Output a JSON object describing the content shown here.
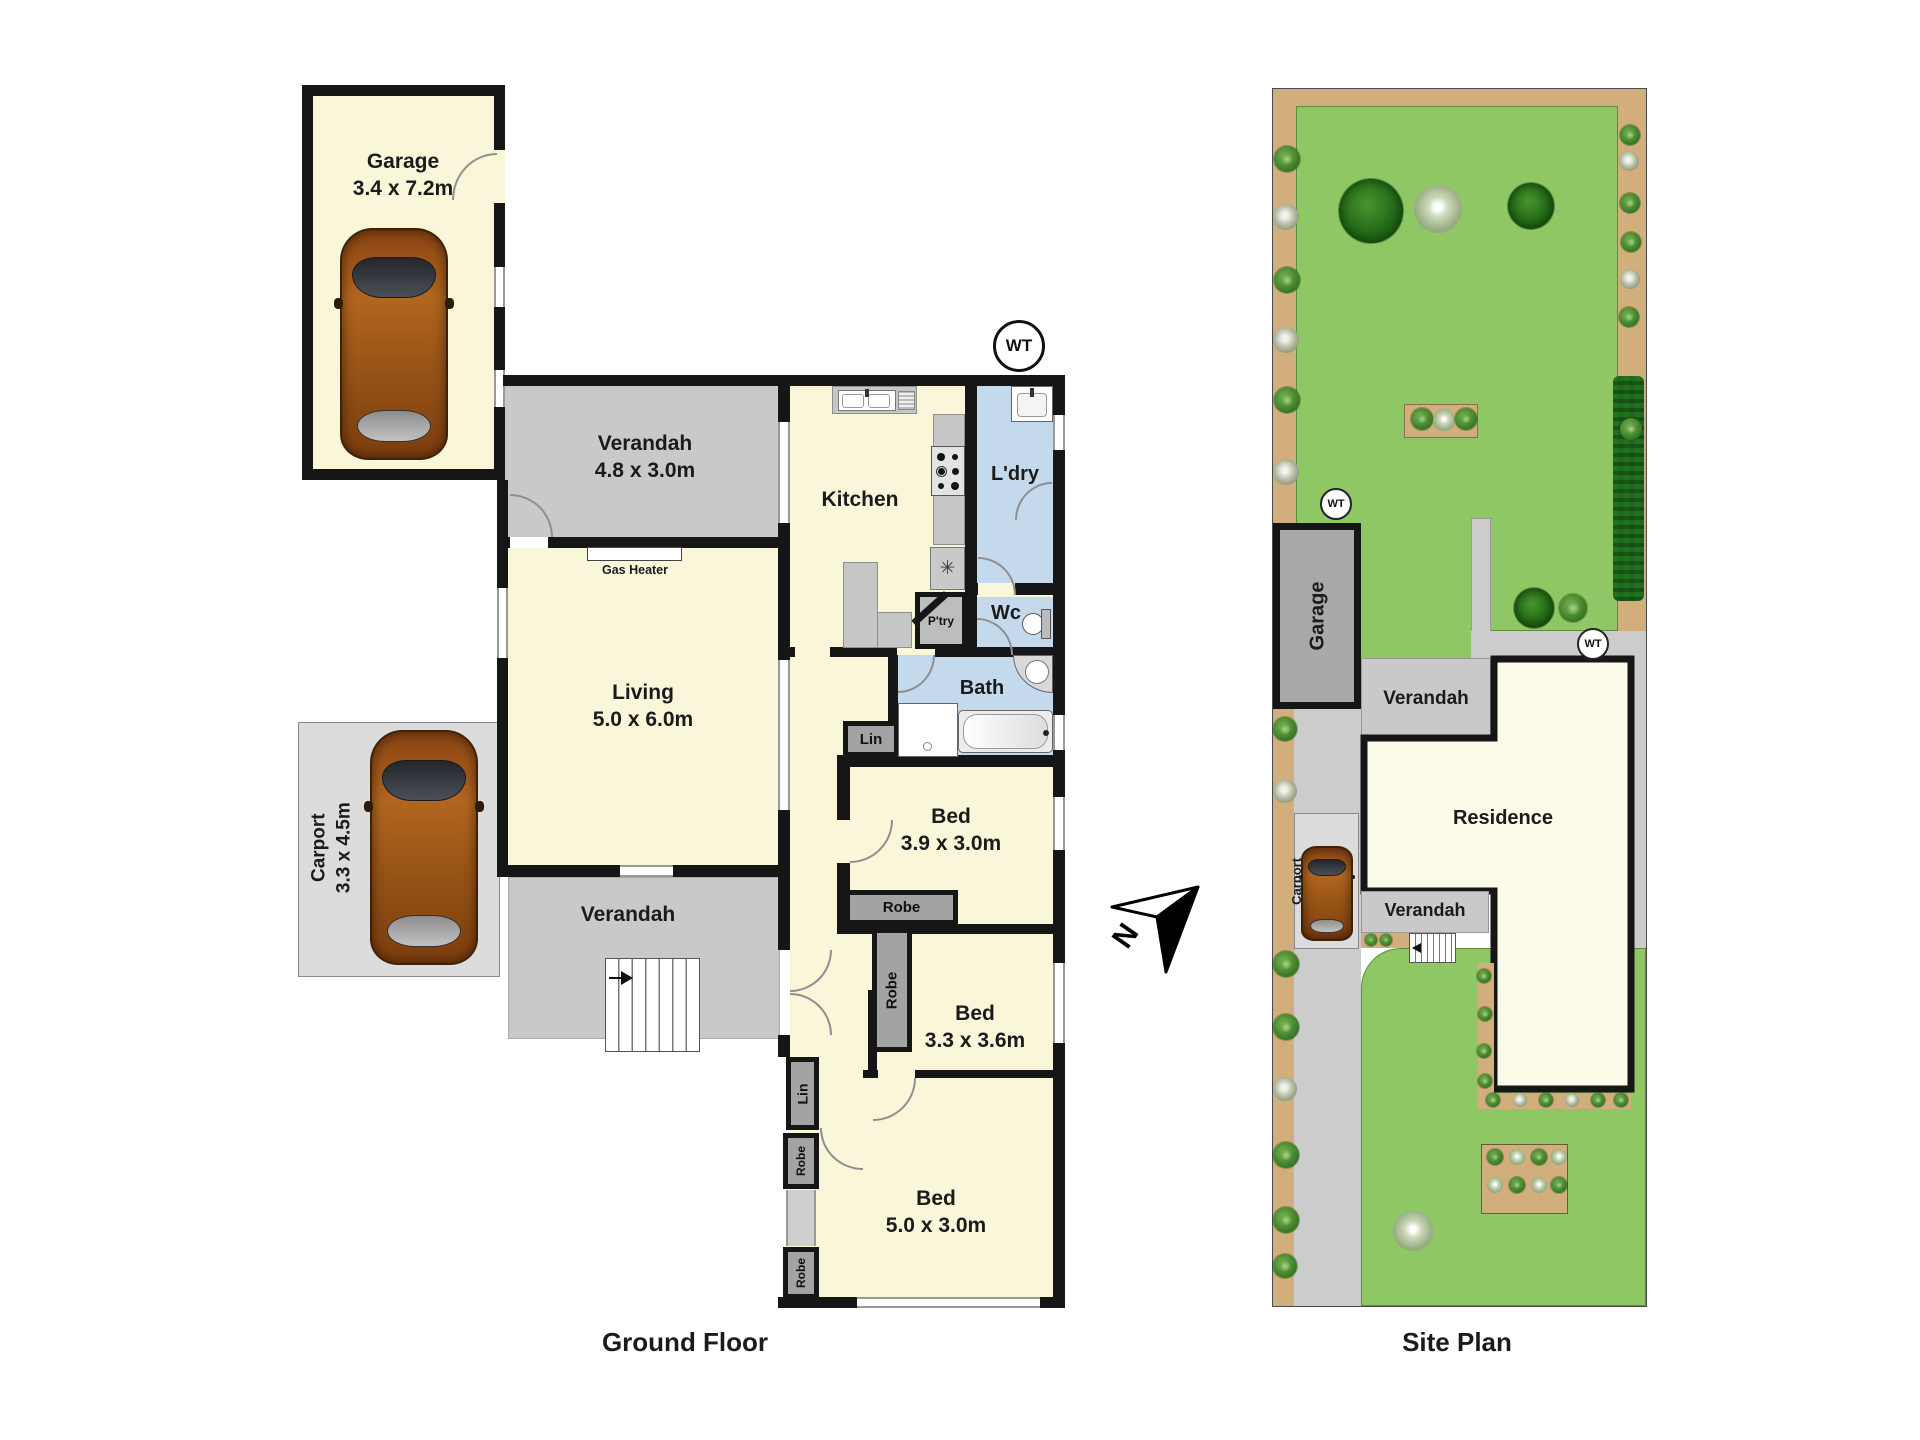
{
  "ground_floor": {
    "title": "Ground Floor",
    "garage": {
      "name": "Garage",
      "dims": "3.4 x 7.2m"
    },
    "verandah_top": {
      "name": "Verandah",
      "dims": "4.8 x 3.0m"
    },
    "kitchen": {
      "name": "Kitchen"
    },
    "laundry": {
      "name": "L'dry"
    },
    "pantry": {
      "name": "P'try"
    },
    "wc": {
      "name": "Wc"
    },
    "bath": {
      "name": "Bath"
    },
    "living": {
      "name": "Living",
      "dims": "5.0 x 6.0m"
    },
    "gas_heater": "Gas Heater",
    "carport": {
      "name": "Carport",
      "dims": "3.3 x 4.5m"
    },
    "verandah_mid": {
      "name": "Verandah"
    },
    "bed1": {
      "name": "Bed",
      "dims": "3.9 x 3.0m"
    },
    "bed2": {
      "name": "Bed",
      "dims": "3.3 x 3.6m"
    },
    "bed3": {
      "name": "Bed",
      "dims": "5.0 x 3.0m"
    },
    "lin1": "Lin",
    "lin2": "Lin",
    "robe1": "Robe",
    "robe2": "Robe",
    "robe3": "Robe",
    "robe4": "Robe",
    "water_tank": "WT"
  },
  "site_plan": {
    "title": "Site Plan",
    "garage": "Garage",
    "carport": "Carport",
    "residence": "Residence",
    "verandah_upper": "Verandah",
    "verandah_lower": "Verandah",
    "wt_top": "WT",
    "wt_right": "WT"
  },
  "compass": {
    "north_label": "N"
  },
  "icons": {
    "dishwasher": "✳"
  },
  "colors": {
    "wall": "#161616",
    "room": "#faf6da",
    "residence": "#fcfae8",
    "verandah": "#c9c9c9",
    "carport": "#dcdcdc",
    "storage": "#a3a3a3",
    "wet": "#c5d9ed",
    "counter": "#c6c6c6",
    "lawn": "#8fc764",
    "garden": "#d2ae7c",
    "hedge": "#1c6b1e",
    "drive": "#cccccc",
    "site_garage": "#a9a9a9",
    "car": "#b06020"
  }
}
